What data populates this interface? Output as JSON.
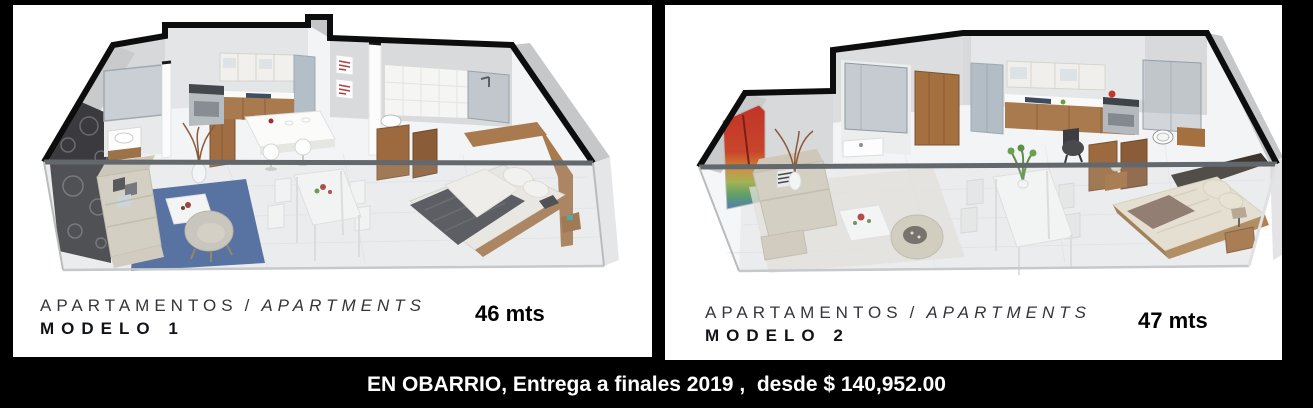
{
  "panels": [
    {
      "caption_primary": "APARTAMENTOS",
      "caption_separator": "/",
      "caption_secondary": "APARTMENTS",
      "model_label": "MODELO 1",
      "area_label": "46 mts",
      "floorplan_description": "3D isometric cutaway floor plan: living room with blue rug and beige sofa, dark floral accent wall, kitchen with island and two stools, dining table, bedroom with dark gray bed, two bathrooms"
    },
    {
      "caption_primary": "APARTAMENTOS",
      "caption_separator": "/",
      "caption_secondary": "APARTMENTS",
      "model_label": "MODELO 2",
      "area_label": "47 mts",
      "floorplan_description": "3D isometric cutaway floor plan: living room with rainbow artwork and beige sofa, glass shower bathrooms, wood-door entry, kitchen along back wall, dining table with plant, bedroom with cream bed and brown throw on dark accent wall"
    }
  ],
  "footer": {
    "text": "EN OBARRIO, Entrega a finales 2019 ,  desde $ 140,952.00"
  },
  "colors": {
    "page_background": "#000000",
    "panel_background": "#ffffff",
    "caption_text": "#34353b",
    "model_text": "#121317",
    "footer_text": "#ffffff",
    "wall_cut_outline": "#0d0d0d",
    "glass_rail": "#63686c",
    "rug_blue": "#45629a",
    "wood": "#a87a4e",
    "duvet_dark_gray": "#4a4b4f",
    "bed_cream": "#ece4d3",
    "throw_brown": "#8b7163",
    "accent_wall_dark": "#3c362f",
    "floral_wall_dark": "#3b3b3f",
    "artwork_red": "#c23327"
  }
}
